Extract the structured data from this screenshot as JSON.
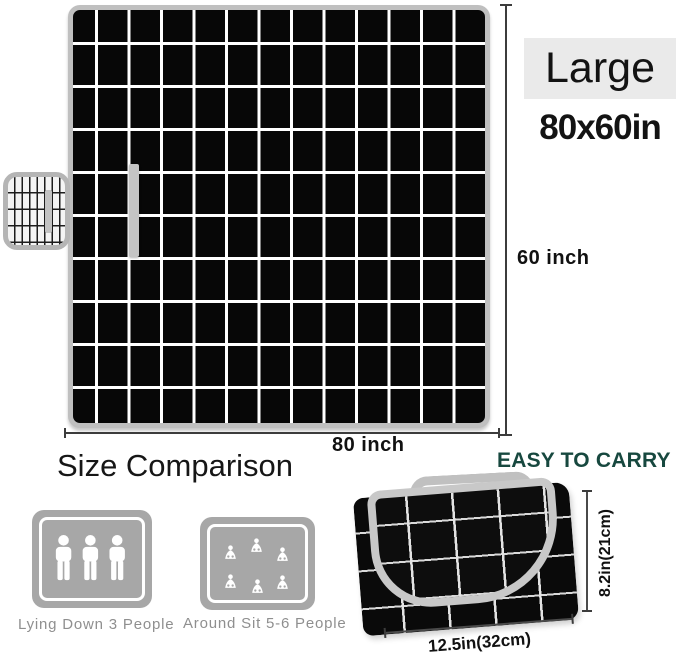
{
  "product_size": {
    "badge": "Large",
    "dimensions": "80x60in",
    "height_label": "60 inch",
    "width_label": "80 inch"
  },
  "size_comparison": {
    "title": "Size Comparison",
    "items": [
      {
        "icon": "three-standing-people-icon",
        "caption": "Lying Down 3 People"
      },
      {
        "icon": "six-sitting-people-icon",
        "caption": "Around Sit 5-6 People"
      }
    ]
  },
  "easy_to_carry": {
    "title": "EASY TO CARRY",
    "folded_height": "8.2in(21cm)",
    "folded_width": "12.5in(32cm)"
  },
  "colors": {
    "blanket_black": "#070707",
    "grid_white": "#ffffff",
    "trim_gray": "#bfbfbf",
    "accent_teal": "#17483f",
    "icon_gray": "#a7a7a7",
    "caption_gray": "#8f8f8f",
    "badge_bg": "#eaeaea"
  }
}
